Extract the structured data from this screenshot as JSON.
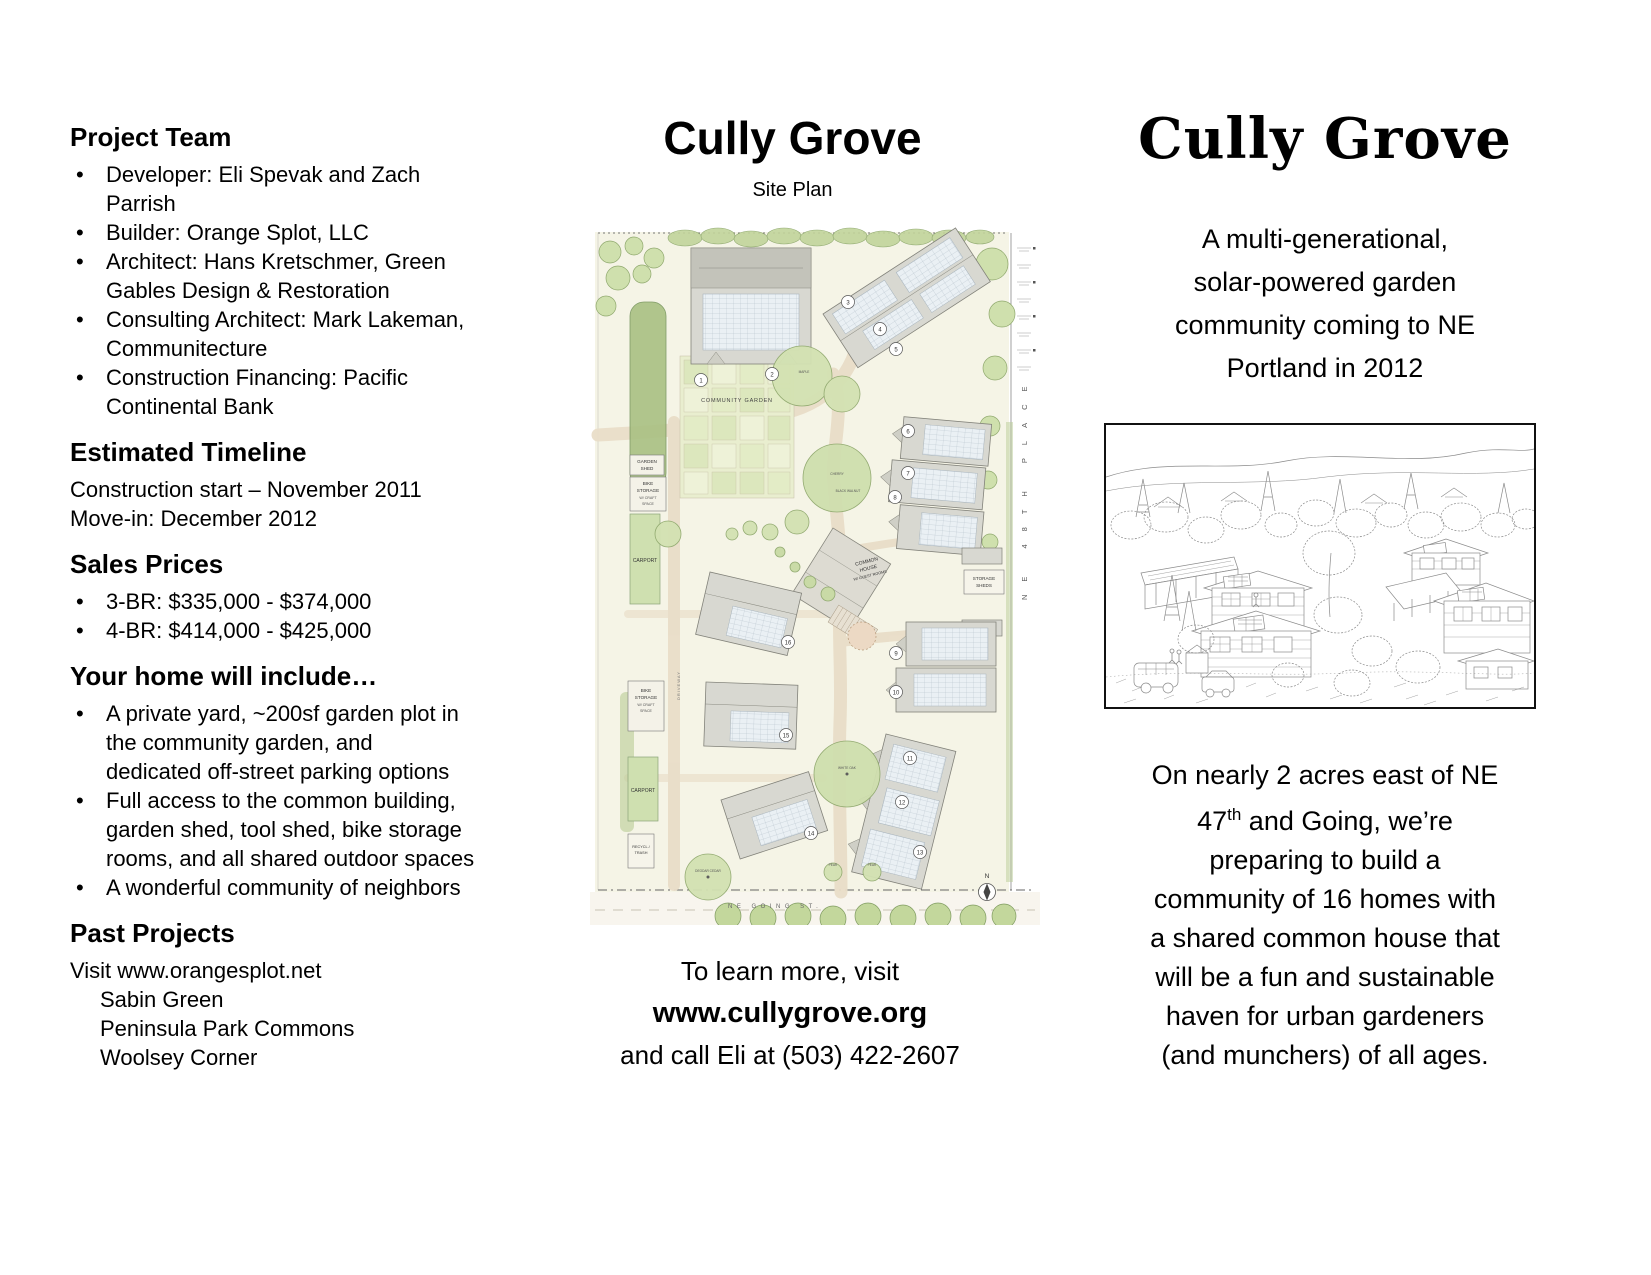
{
  "ui": {
    "bullet": "•"
  },
  "left": {
    "project_team": {
      "title": "Project Team",
      "items": [
        [
          "Developer: Eli Spevak and Zach",
          "Parrish"
        ],
        [
          "Builder: Orange Splot, LLC"
        ],
        [
          "Architect: Hans Kretschmer, Green",
          "Gables Design & Restoration"
        ],
        [
          "Consulting Architect: Mark Lakeman,",
          "Communitecture"
        ],
        [
          "Construction Financing: Pacific",
          "Continental Bank"
        ]
      ]
    },
    "timeline": {
      "title": "Estimated Timeline",
      "lines": [
        "Construction start – November 2011",
        "Move-in: December 2012"
      ]
    },
    "prices": {
      "title": "Sales Prices",
      "items": [
        [
          "3-BR: $335,000 - $374,000"
        ],
        [
          "4-BR: $414,000 - $425,000"
        ]
      ]
    },
    "includes": {
      "title": "Your home will include…",
      "items": [
        [
          "A private yard, ~200sf garden plot in",
          "the community garden, and",
          "dedicated off-street parking options"
        ],
        [
          "Full access to the common building,",
          "garden shed, tool shed, bike storage",
          "rooms, and all shared outdoor spaces"
        ],
        [
          "A wonderful community of neighbors"
        ]
      ]
    },
    "past": {
      "title": "Past Projects",
      "intro": "Visit www.orangesplot.net",
      "projects": [
        "Sabin Green",
        "Peninsula Park Commons",
        "Woolsey Corner"
      ]
    }
  },
  "middle": {
    "title": "Cully Grove",
    "subtitle": "Site Plan",
    "footer": {
      "line1": "To learn more, visit",
      "line2": "www.cullygrove.org",
      "line3": "and call Eli at (503) 422-2607"
    }
  },
  "plan": {
    "community_garden": "COMMUNITY GARDEN",
    "garden_shed": [
      "GARDEN",
      "SHED"
    ],
    "bike_storage": [
      "BIKE",
      "STORAGE",
      "W/ CRAFT",
      "SPACE"
    ],
    "carport": "CARPORT",
    "recycling": [
      "RECYCL./",
      "TRASH"
    ],
    "common_house": [
      "COMMON",
      "HOUSE",
      "W/ GUEST ROOMS"
    ],
    "storage_sheds": [
      "STORAGE",
      "SHEDS"
    ],
    "driveway": "DRIVEWAY",
    "street_right": "NE 48TH PLACE",
    "street_bottom": "NE GOING ST.",
    "north": "N",
    "units": [
      "1",
      "2",
      "3",
      "4",
      "5",
      "6",
      "7",
      "8",
      "9",
      "10",
      "11",
      "12",
      "13",
      "14",
      "15",
      "16"
    ],
    "trees": {
      "maple": "MAPLE",
      "cherry": "CHERRY",
      "black_walnut": "BLACK WALNUT",
      "white_oak": "WHITE OAK",
      "deodar_cedar": "DEODAR CEDAR",
      "pear1": "PEAR",
      "pear2": "PEAR"
    }
  },
  "right": {
    "title": "Cully Grove",
    "tagline": [
      "A multi-generational,",
      "solar-powered garden",
      "community coming to NE",
      "Portland in 2012"
    ],
    "paragraph": {
      "l1": "On nearly 2 acres east of NE",
      "l2_pre": "47",
      "l2_sup": "th",
      "l2_post": " and Going, we’re",
      "l3": "preparing to build a",
      "l4": "community of 16 homes with",
      "l5": "a shared common house that",
      "l6": "will be a fun and sustainable",
      "l7": "haven for urban gardeners",
      "l8": "(and munchers) of all ages."
    }
  }
}
